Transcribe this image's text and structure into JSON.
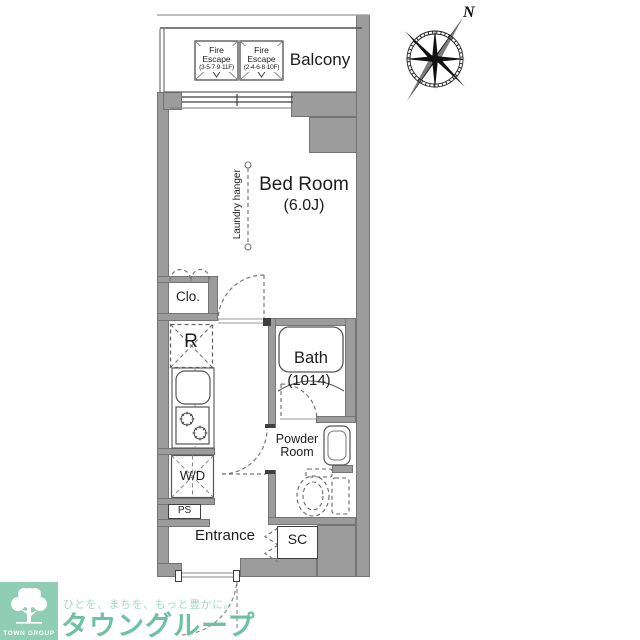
{
  "plan": {
    "balcony": {
      "label": "Balcony"
    },
    "fire_escape_1": {
      "line1": "Fire",
      "line2": "Escape",
      "line3": "(3·5·7·9·11F)"
    },
    "fire_escape_2": {
      "line1": "Fire",
      "line2": "Escape",
      "line3": "(2·4·6·8·10F)"
    },
    "bedroom": {
      "label": "Bed Room",
      "size": "(6.0J)"
    },
    "laundry_hanger": {
      "label": "Laundry hanger"
    },
    "closet": {
      "label": "Clo."
    },
    "refrigerator": {
      "label": "R"
    },
    "bath": {
      "label": "Bath",
      "size": "(1014)"
    },
    "powder_room": {
      "line1": "Powder",
      "line2": "Room"
    },
    "washer_dryer": {
      "label": "W/D"
    },
    "pipe_space": {
      "label": "PS"
    },
    "entrance": {
      "label": "Entrance"
    },
    "shoe_closet": {
      "label": "SC"
    },
    "compass": {
      "north_label": "N"
    }
  },
  "branding": {
    "logo_text": "TOWN GROUP",
    "tagline": "ひとを、まちを、もっと豊かに。",
    "company": "タウングループ",
    "brand_green": "#6ec2a2",
    "logo_bg_green": "#8fcdb4",
    "tagline_green": "#a6d8c6"
  },
  "colors": {
    "wall_gray": "#9c9c9c",
    "line_dark": "#3f3f3f"
  }
}
